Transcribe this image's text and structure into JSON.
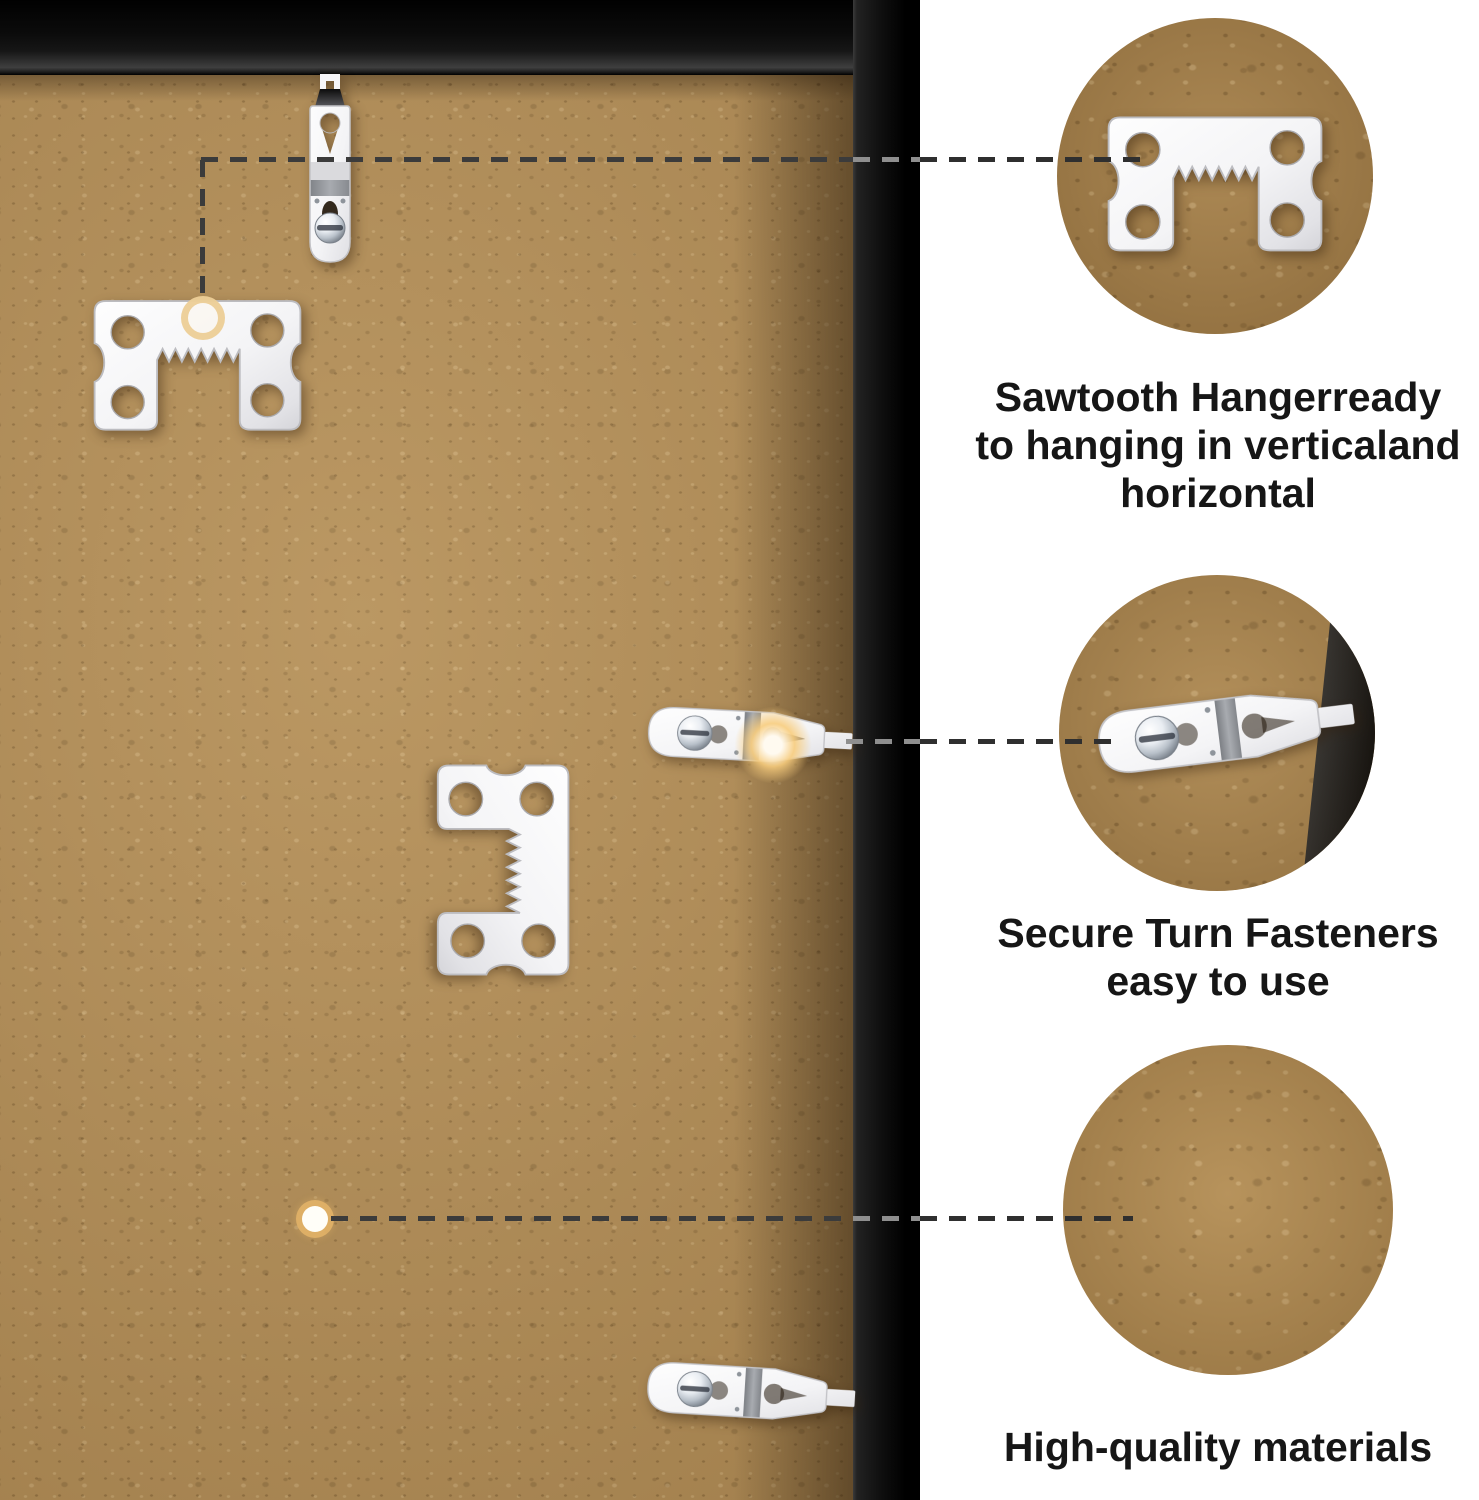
{
  "image": {
    "kind": "picture-frame back hardware feature annotation",
    "width": 1479,
    "height": 1500
  },
  "colors": {
    "background": "#ffffff",
    "backboard_wood": "#b38e57",
    "frame_black": "#0a0a0a",
    "metal_hardware": "#f2f2f5",
    "accent_gold": "#e7c387",
    "dashed_line": "#3b3b3b",
    "caption_text": "#161616"
  },
  "callouts": [
    {
      "id": "sawtooth-hanger",
      "lines": [
        "Sawtooth Hangerready",
        "to hanging in verticaland",
        "horizontal"
      ]
    },
    {
      "id": "turn-fastener",
      "lines": [
        "Secure Turn Fasteners",
        "easy to use"
      ]
    },
    {
      "id": "materials",
      "lines": [
        "High-quality materials"
      ]
    }
  ]
}
